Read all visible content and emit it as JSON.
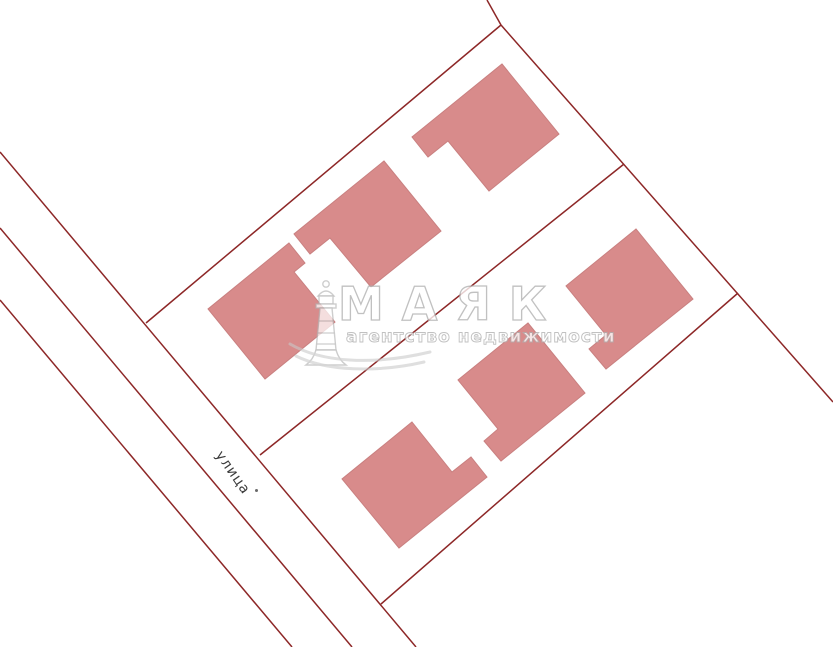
{
  "map": {
    "colors": {
      "background": "#ffffff",
      "boundary": "#8d2727",
      "building_fill": "#d88b8b",
      "building_stroke": "#c98080"
    },
    "street_label": {
      "text": "улица",
      "x": 225,
      "y": 448,
      "rotation_deg": 55,
      "font_size_px": 14,
      "color": "#3b3b3b",
      "dot_x": 255,
      "dot_y": 489
    },
    "boundary_lines": [
      {
        "name": "street-edge-west",
        "x1": 0,
        "y1": 152,
        "x2": 416,
        "y2": 647
      },
      {
        "name": "street-edge-middle",
        "x1": 0,
        "y1": 228,
        "x2": 352,
        "y2": 647
      },
      {
        "name": "street-edge-east",
        "x1": 0,
        "y1": 300,
        "x2": 292,
        "y2": 647
      },
      {
        "name": "block-north-boundary",
        "x1": 501,
        "y1": 25,
        "x2": 146,
        "y2": 323
      },
      {
        "name": "block-east-boundary",
        "x1": 501,
        "y1": 25,
        "x2": 833,
        "y2": 402
      },
      {
        "name": "north-edge-stub",
        "x1": 487,
        "y1": 0,
        "x2": 501,
        "y2": 25
      },
      {
        "name": "mid-block-boundary",
        "x1": 624,
        "y1": 164,
        "x2": 260,
        "y2": 455
      },
      {
        "name": "block-south-boundary",
        "x1": 738,
        "y1": 293,
        "x2": 381,
        "y2": 604
      }
    ],
    "buildings": [
      {
        "id": "building-1",
        "points": "502,64 559,134 489,191 448,141 428,157 412,137"
      },
      {
        "id": "building-2",
        "points": "384,161 441,231 371,287 330,238 310,254 294,234"
      },
      {
        "id": "building-3",
        "points": "289,243 305,263 294,272 335,322 265,379 208,309"
      },
      {
        "id": "building-4",
        "points": "636,229 693,299 606,369 589,349 606,335 566,286"
      },
      {
        "id": "building-5",
        "points": "528,323 585,393 501,461 484,441 498,429 458,380"
      },
      {
        "id": "building-6",
        "points": "412,422 452,472 471,457 487,477 399,548 342,479"
      }
    ]
  },
  "watermark": {
    "title": "МАЯК",
    "subtitle": "агентство недвижимости",
    "text_color": "#ffffff",
    "outline_color": "#b0b0b0"
  }
}
